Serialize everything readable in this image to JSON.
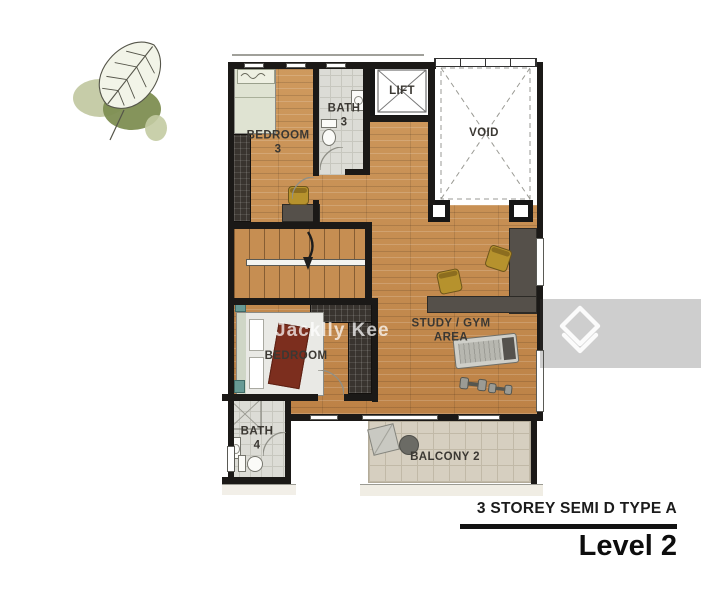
{
  "branding": {
    "leaf_logo": "monstera-leaf-logo"
  },
  "watermark": {
    "name": "Jacklly Kee",
    "portal_icon": "chevron-house-logo"
  },
  "floorplan": {
    "rooms": {
      "bedroom3": {
        "line1": "BEDROOM",
        "line2": "3"
      },
      "bath3": {
        "line1": "BATH",
        "line2": "3"
      },
      "lift": {
        "label": "LIFT"
      },
      "void": {
        "label": "VOID"
      },
      "bedroom2": {
        "label": "BEDROOM"
      },
      "study_gym": {
        "line1": "STUDY / GYM",
        "line2": "AREA"
      },
      "bath4": {
        "line1": "BATH",
        "line2": "4"
      },
      "balcony2": {
        "label": "BALCONY 2"
      }
    },
    "furniture": [
      "bed",
      "wardrobe",
      "desk",
      "chair",
      "toilet",
      "sink",
      "shower",
      "stairs",
      "handrail",
      "treadmill",
      "dumbbells",
      "balcony-chair",
      "balcony-table"
    ],
    "colors": {
      "wood_floor": "#c68e52",
      "wall": "#1b1917",
      "bath_tile": "#dcdcd6",
      "balcony_tile": "#d6cfc0",
      "furniture_dark": "#55504a",
      "chair_olive": "#b6922d",
      "bed_sage": "#dfe3d2",
      "blanket_red": "#7c2e1e",
      "logo_leaf_green": "#7e8e52"
    }
  },
  "footer": {
    "plan_type": "3 STOREY SEMI D TYPE A",
    "level": "Level 2"
  }
}
